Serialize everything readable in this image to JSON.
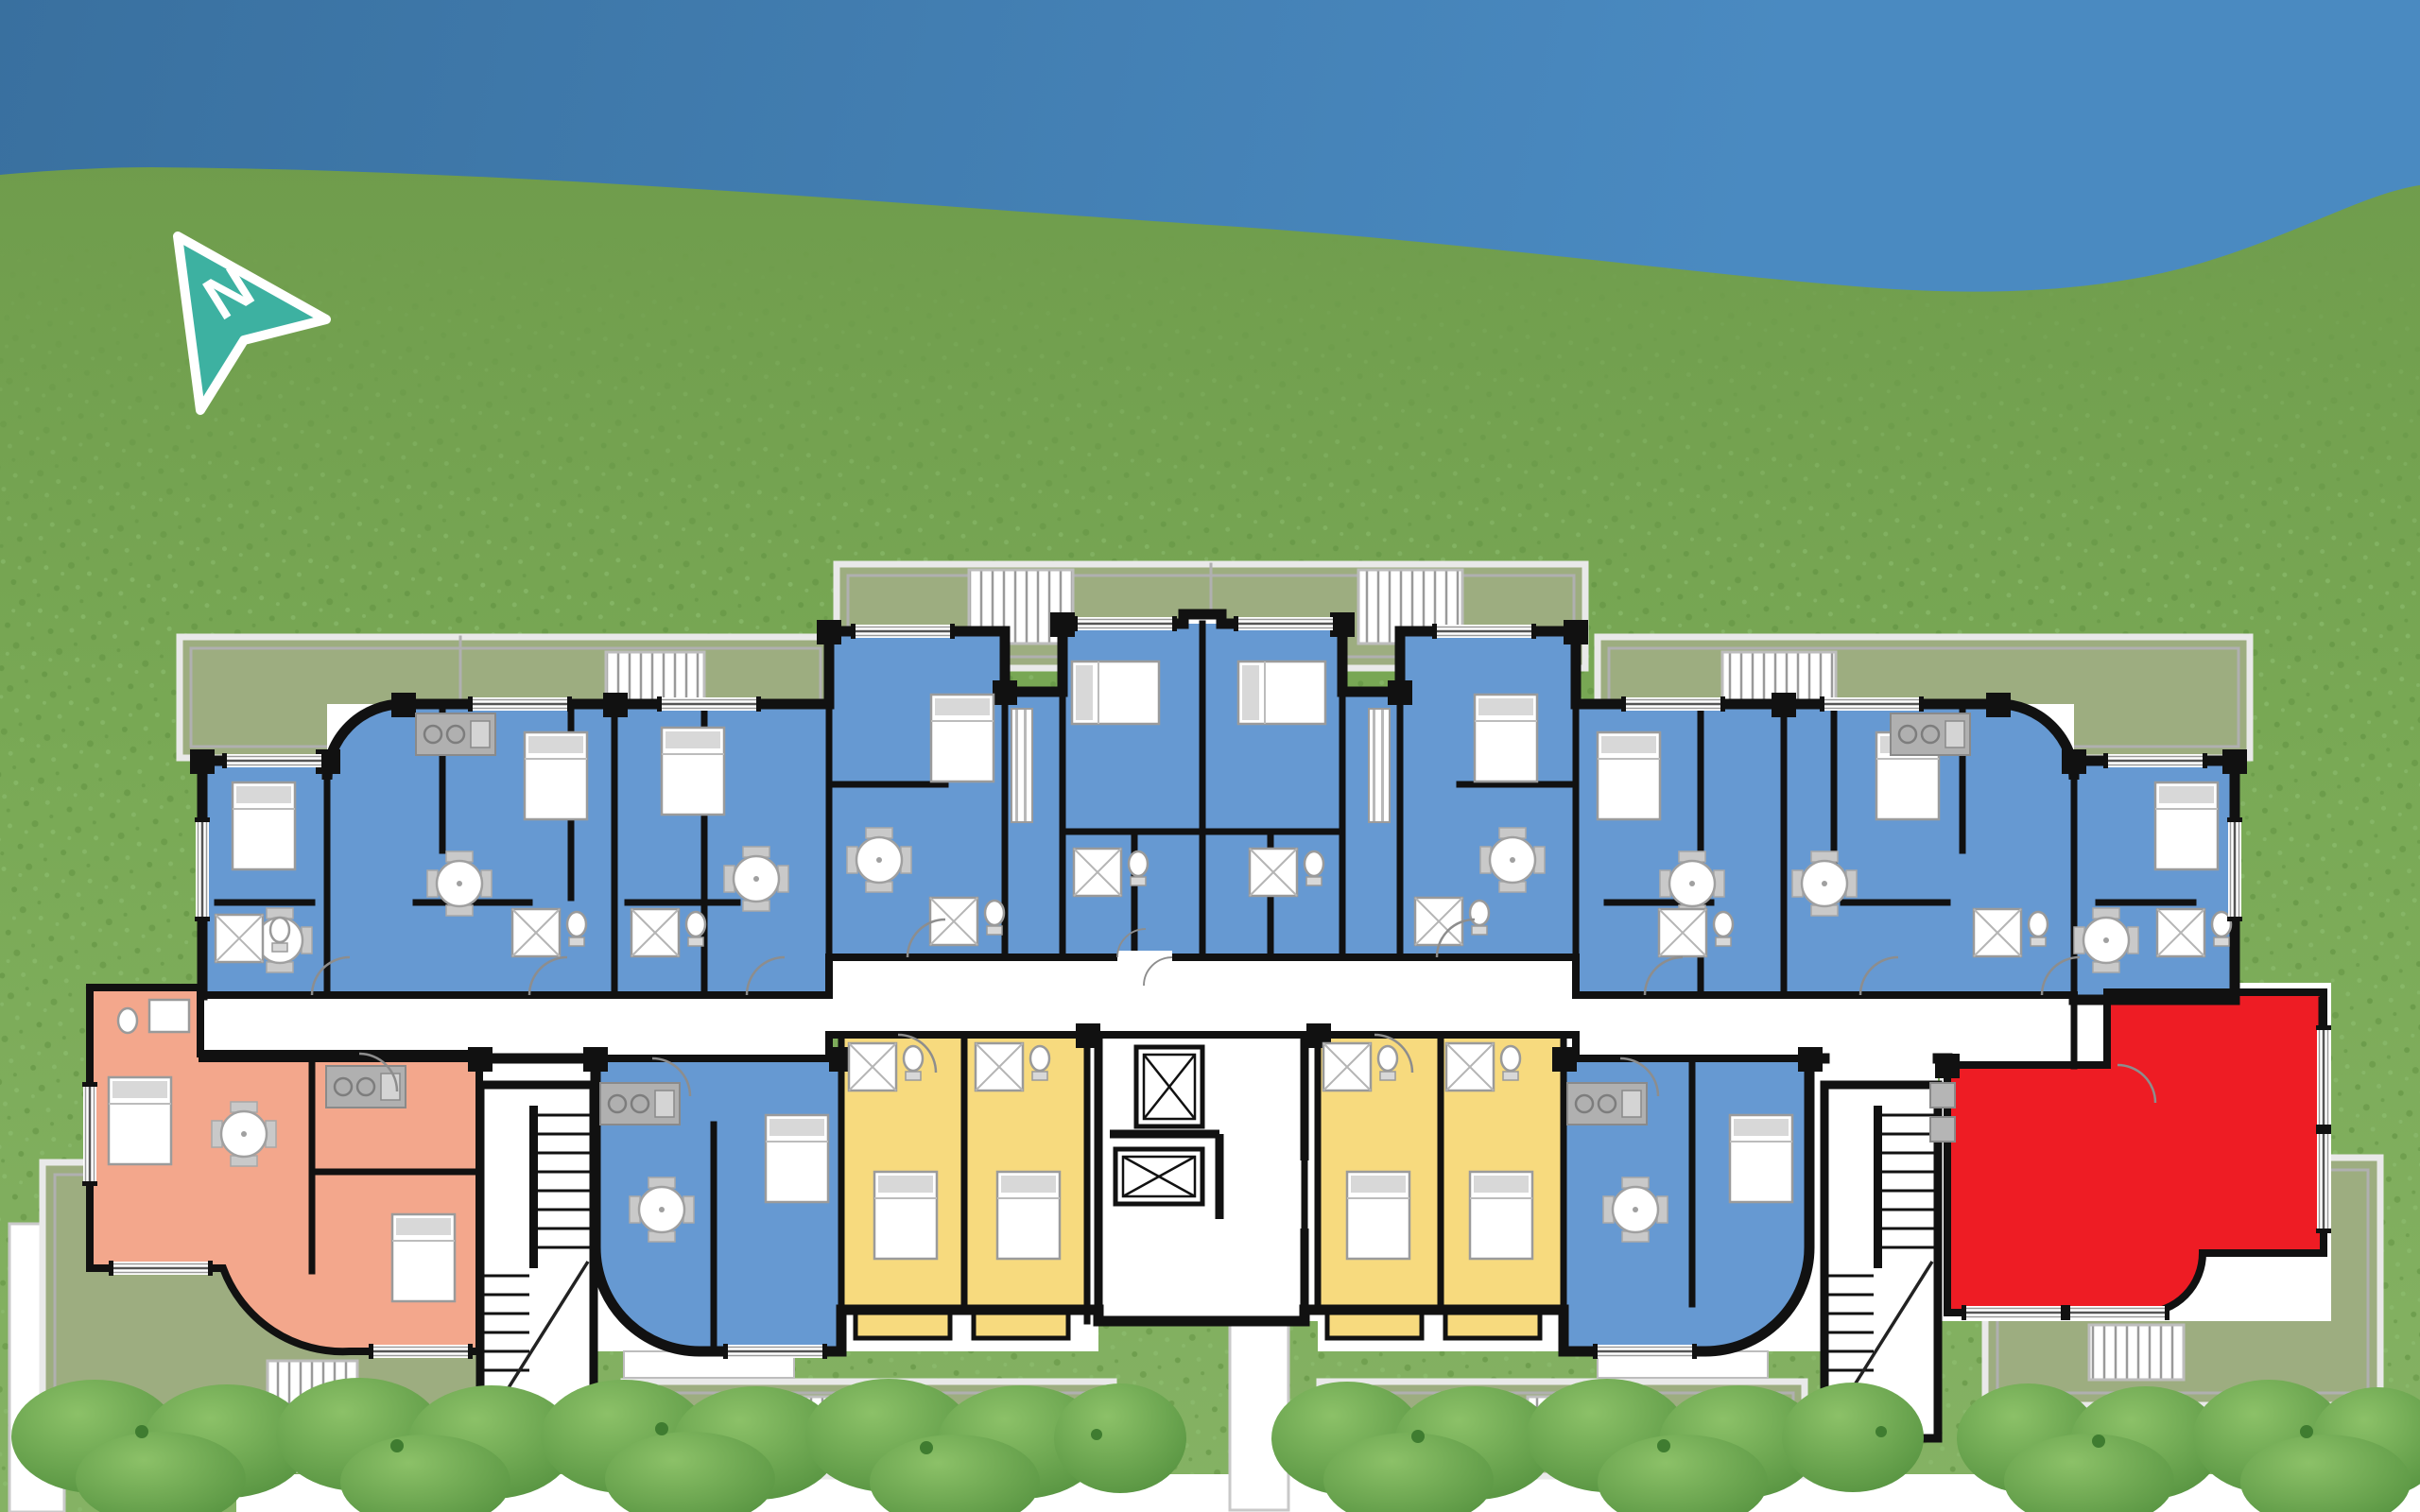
{
  "compass": {
    "label": "N"
  },
  "colors": {
    "sky_top": "#39709f",
    "sky_bottom": "#4a8ac1",
    "lawn_top": "#6f9c4c",
    "lawn_mid": "#79a955",
    "lawn_bottom": "#85b264",
    "grass_speck_dark": "#5f9040",
    "grass_speck_light": "#90c073",
    "bush_light": "#8cc168",
    "bush_dark": "#4e8c3a",
    "bush_speck": "#3f7c30",
    "terrace_fill": "#9dad80",
    "terrace_frame_outer": "#e9e9e9",
    "terrace_frame_inner": "#b0b0b0",
    "grille_line": "#9a9a9a",
    "wall": "#111111",
    "floor": "#ffffff",
    "walkway": "#ffffff",
    "unit_blue": "#6699d2",
    "unit_yellow": "#f7da7e",
    "unit_salmon": "#f3a78c",
    "unit_red": "#ee1c24",
    "furniture_fill": "#ffffff",
    "furniture_gray": "#c9c9c9",
    "fixture_stroke": "#9a9a9a",
    "door_arc": "#8d8d8d",
    "compass_teal": "#3db1a1",
    "compass_outline": "#ffffff"
  },
  "apartments": {
    "blue_count": 14,
    "yellow_count": 4,
    "salmon_count": 1,
    "red_count": 1,
    "highlighted_unit_color": "#ee1c24"
  }
}
